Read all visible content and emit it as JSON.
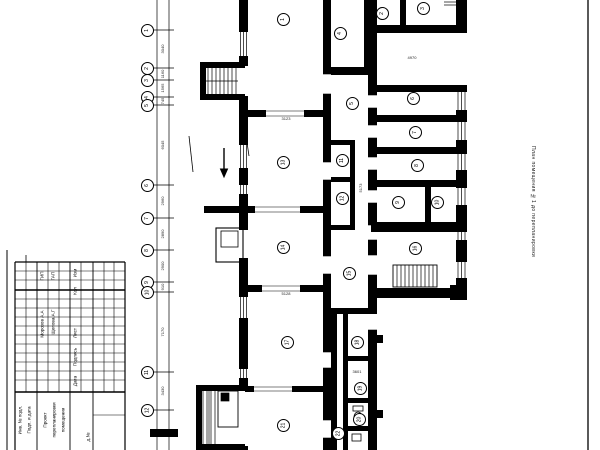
{
  "sheet": {
    "margin_title": "План помещения №1 до перепланировки"
  },
  "title_block": {
    "cells": [
      {
        "t": "ГИП",
        "x": 42.5,
        "y": 276
      },
      {
        "t": "ГАП",
        "x": 53.5,
        "y": 276
      },
      {
        "t": "Морозов А.А",
        "x": 42.5,
        "y": 324
      },
      {
        "t": "Щепова А.Г",
        "x": 53.5,
        "y": 322
      },
      {
        "t": "Изм",
        "x": 75.5,
        "y": 273
      },
      {
        "t": "Кол",
        "x": 75.5,
        "y": 291
      },
      {
        "t": "Лист",
        "x": 75.5,
        "y": 333
      },
      {
        "t": "Подпись",
        "x": 75.5,
        "y": 357
      },
      {
        "t": "Дата",
        "x": 75.5,
        "y": 381
      },
      {
        "t": "Подп. и дата",
        "x": 30,
        "y": 420
      },
      {
        "t": "Инв. № подл.",
        "x": 21,
        "y": 420
      },
      {
        "t": "Проект",
        "x": 46,
        "y": 420
      },
      {
        "t": "перепланировки",
        "x": 55,
        "y": 420
      },
      {
        "t": "помещения",
        "x": 64,
        "y": 420
      },
      {
        "t": "д.№",
        "x": 89,
        "y": 437
      }
    ]
  },
  "axes": [
    {
      "n": "1",
      "y": 30
    },
    {
      "n": "2",
      "y": 68
    },
    {
      "n": "3",
      "y": 80
    },
    {
      "n": "4",
      "y": 97
    },
    {
      "n": "5",
      "y": 105
    },
    {
      "n": "6",
      "y": 185
    },
    {
      "n": "7",
      "y": 218
    },
    {
      "n": "8",
      "y": 250
    },
    {
      "n": "9",
      "y": 282
    },
    {
      "n": "10",
      "y": 292
    },
    {
      "n": "11",
      "y": 372
    },
    {
      "n": "12",
      "y": 410
    }
  ],
  "rooms": [
    {
      "n": "1",
      "x": 283,
      "y": 19
    },
    {
      "n": "2",
      "x": 382,
      "y": 13
    },
    {
      "n": "3",
      "x": 423,
      "y": 8
    },
    {
      "n": "4",
      "x": 340,
      "y": 33
    },
    {
      "n": "5",
      "x": 352,
      "y": 103
    },
    {
      "n": "6",
      "x": 413,
      "y": 98
    },
    {
      "n": "7",
      "x": 415,
      "y": 132
    },
    {
      "n": "8",
      "x": 417,
      "y": 165
    },
    {
      "n": "9",
      "x": 398,
      "y": 202
    },
    {
      "n": "10",
      "x": 437,
      "y": 202
    },
    {
      "n": "11",
      "x": 342,
      "y": 160
    },
    {
      "n": "12",
      "x": 342,
      "y": 198
    },
    {
      "n": "13",
      "x": 283,
      "y": 162
    },
    {
      "n": "14",
      "x": 283,
      "y": 247
    },
    {
      "n": "15",
      "x": 349,
      "y": 273
    },
    {
      "n": "16",
      "x": 415,
      "y": 248
    },
    {
      "n": "17",
      "x": 287,
      "y": 342
    },
    {
      "n": "18",
      "x": 357,
      "y": 342
    },
    {
      "n": "19",
      "x": 360,
      "y": 388
    },
    {
      "n": "20",
      "x": 359,
      "y": 419
    },
    {
      "n": "21",
      "x": 283,
      "y": 425
    },
    {
      "n": "22",
      "x": 338,
      "y": 433
    }
  ],
  "dims": [
    {
      "t": "3040",
      "x": 163,
      "y": 49,
      "rot": true
    },
    {
      "t": "1160",
      "x": 163,
      "y": 74,
      "rot": true
    },
    {
      "t": "1565",
      "x": 163,
      "y": 88,
      "rot": true
    },
    {
      "t": "745",
      "x": 163,
      "y": 101,
      "rot": true
    },
    {
      "t": "6045",
      "x": 163,
      "y": 145,
      "rot": true
    },
    {
      "t": "2960",
      "x": 163,
      "y": 201,
      "rot": true
    },
    {
      "t": "2890",
      "x": 163,
      "y": 234,
      "rot": true
    },
    {
      "t": "2900",
      "x": 163,
      "y": 266,
      "rot": true
    },
    {
      "t": "910",
      "x": 163,
      "y": 287,
      "rot": true
    },
    {
      "t": "7170",
      "x": 163,
      "y": 332,
      "rot": true
    },
    {
      "t": "3430",
      "x": 163,
      "y": 391,
      "rot": true
    },
    {
      "t": "3123",
      "x": 286,
      "y": 119,
      "rot": false
    },
    {
      "t": "5128",
      "x": 286,
      "y": 294,
      "rot": false
    },
    {
      "t": "4970",
      "x": 412,
      "y": 58,
      "rot": false
    },
    {
      "t": "5173",
      "x": 361,
      "y": 188,
      "rot": true
    },
    {
      "t": "3601",
      "x": 357,
      "y": 372,
      "rot": false
    }
  ]
}
